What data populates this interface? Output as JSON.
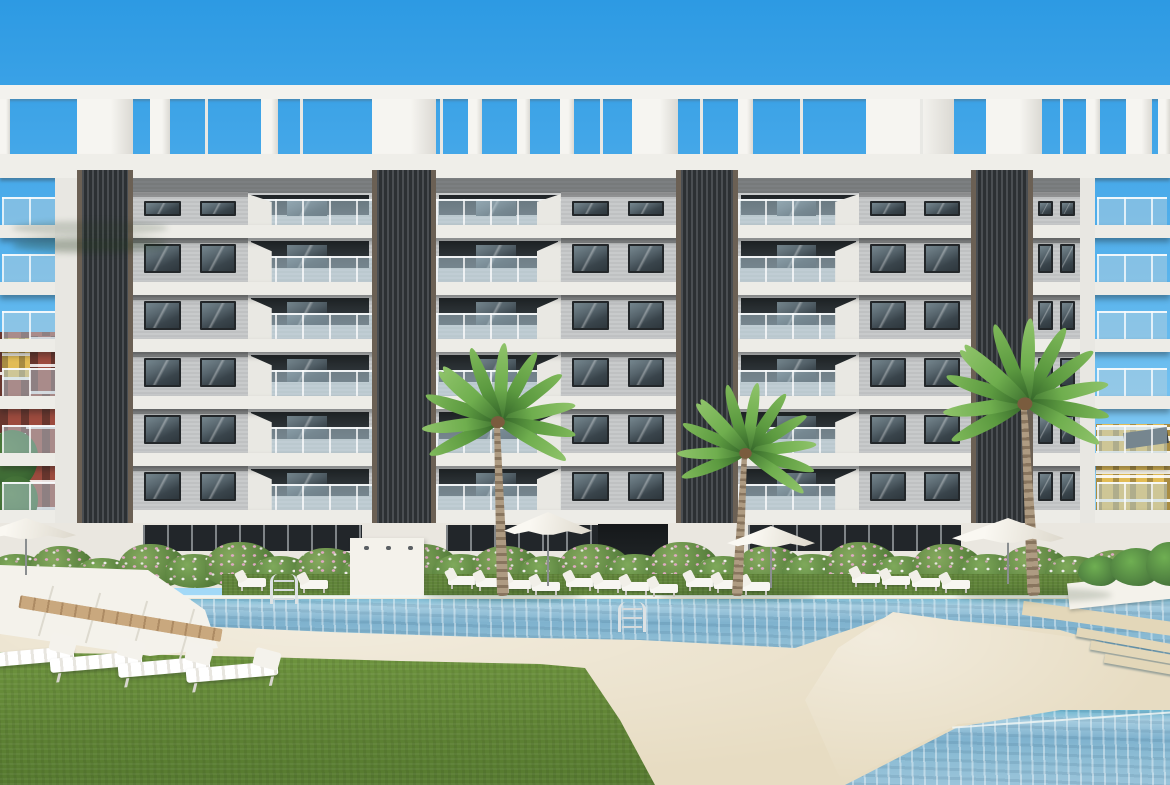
{
  "scene": {
    "description": "3D architectural render of a modern white-and-grey apartment complex with rooftop pergola, balconies, dark louvre columns, flowering hedge, palm trees, parasols, sun loungers, lawns and turquoise swimming pools",
    "colors": {
      "sky_top": "#2d9ae3",
      "sky_horizon": "#cdecfb",
      "facade_wall": "#c5c7c8",
      "slab_white": "#edece7",
      "fascia": "#efeee9",
      "louvre_column": "#303437",
      "column_trim": "#6b6054",
      "window_glass": "#4a575f",
      "balustrade_glass": "#b7d1dd",
      "hedge_green": "#5c8440",
      "flower_pink": "#e2aac8",
      "flower_white": "#f5f0f2",
      "pool_water": "#7fb2ce",
      "deck_sand": "#e7dcc2",
      "grass": "#61853a",
      "wood_deck": "#c9a87e",
      "palm_frond": "#5c9a40",
      "palm_trunk": "#ae9b82",
      "parasol": "#faf8f2",
      "bg_building_red": "#9c4b3e",
      "bg_building_yellow": "#e2bc55"
    },
    "background": {
      "left_blocks": [
        {
          "x": 0,
          "y": 332,
          "w": 62,
          "h": 232,
          "cls": "bgred"
        },
        {
          "x": 2,
          "y": 338,
          "w": 38,
          "h": 42,
          "cls": "bgyellow"
        },
        {
          "x": 0,
          "y": 390,
          "w": 26,
          "h": 46,
          "cls": "bgred"
        },
        {
          "x": 30,
          "y": 336,
          "w": 32,
          "h": 58,
          "cls": "bgred"
        }
      ],
      "left_greens": [
        {
          "x": -14,
          "y": 430,
          "w": 52,
          "h": 58
        },
        {
          "x": -6,
          "y": 476,
          "w": 44,
          "h": 52
        },
        {
          "x": 2,
          "y": 512,
          "w": 40,
          "h": 44
        }
      ],
      "right_block": {
        "x": 1096,
        "y": 424,
        "w": 74,
        "h": 102
      },
      "right_bands": [
        {
          "x": 1096,
          "y": 436,
          "w": 74,
          "h": 5
        },
        {
          "x": 1096,
          "y": 470,
          "w": 74,
          "h": 4
        }
      ],
      "right_solar": {
        "x": 1124,
        "y": 430,
        "w": 44,
        "h": 16
      },
      "right_greens": [
        {
          "x": 1130,
          "y": 518,
          "w": 44,
          "h": 36
        }
      ]
    },
    "pergola": {
      "beam": {
        "y": 85,
        "h": 14
      },
      "piers_y": 99,
      "piers_h": 55,
      "piers": [
        [
          0,
          10
        ],
        [
          77,
          56
        ],
        [
          150,
          20
        ],
        [
          205,
          3
        ],
        [
          261,
          17
        ],
        [
          300,
          3
        ],
        [
          372,
          64
        ],
        [
          440,
          3
        ],
        [
          468,
          14
        ],
        [
          517,
          13
        ],
        [
          560,
          14
        ],
        [
          600,
          3
        ],
        [
          632,
          46
        ],
        [
          700,
          3
        ],
        [
          738,
          15
        ],
        [
          800,
          3
        ],
        [
          866,
          88
        ],
        [
          920,
          3
        ],
        [
          986,
          56
        ],
        [
          1060,
          3
        ],
        [
          1086,
          14
        ],
        [
          1126,
          26
        ],
        [
          1158,
          12
        ]
      ],
      "fascia": {
        "y": 154,
        "h": 24
      }
    },
    "facade": {
      "wall": {
        "x": 66,
        "y": 178,
        "w": 1014,
        "h": 345
      },
      "roof_shadow_h": 15,
      "slab_ys": [
        225,
        282,
        339,
        396,
        453,
        510
      ],
      "slab_h": 13,
      "rows": [
        {
          "y": 192,
          "h": 33,
          "attic": true
        },
        {
          "y": 238,
          "h": 44
        },
        {
          "y": 295,
          "h": 44
        },
        {
          "y": 352,
          "h": 44
        },
        {
          "y": 409,
          "h": 44
        },
        {
          "y": 466,
          "h": 44
        }
      ],
      "bays": [
        {
          "x": 2,
          "w": 54,
          "type": "open"
        },
        {
          "x": 133,
          "w": 239,
          "type": "wb"
        },
        {
          "x": 436,
          "w": 240,
          "type": "bw"
        },
        {
          "x": 738,
          "w": 233,
          "type": "bw"
        },
        {
          "x": 1033,
          "w": 47,
          "type": "sw"
        },
        {
          "x": 1097,
          "w": 70,
          "type": "open"
        }
      ],
      "columns": [
        [
          77,
          56
        ],
        [
          372,
          64
        ],
        [
          676,
          62
        ],
        [
          971,
          62
        ]
      ],
      "column_top": 170,
      "column_bottom": 548,
      "end_walls": [
        [
          55,
          22
        ],
        [
          1080,
          15
        ]
      ]
    },
    "ground": {
      "wall": {
        "y": 523,
        "h": 65
      },
      "entrance": {
        "x": 598,
        "y": 524,
        "w": 70,
        "h": 60
      },
      "shower_wall": {
        "x": 350,
        "y": 538,
        "w": 74,
        "h": 58,
        "dots": 3
      },
      "grass_strip": {
        "x": 222,
        "y": 574,
        "w": 858,
        "h": 26
      },
      "planter": {
        "x": 1068,
        "y": 578,
        "w": 104,
        "h": 26
      },
      "planter_greens": [
        {
          "x": 1078,
          "y": 556,
          "w": 42,
          "h": 30
        },
        {
          "x": 1110,
          "y": 548,
          "w": 52,
          "h": 38
        },
        {
          "x": 1146,
          "y": 542,
          "w": 46,
          "h": 44
        }
      ],
      "deck_plants": [
        {
          "x": 580,
          "y": 700,
          "w": 24,
          "h": 46
        },
        {
          "x": 592,
          "y": 742,
          "w": 20,
          "h": 36
        }
      ]
    },
    "hedge": [
      [
        -12,
        60,
        34,
        1
      ],
      [
        30,
        66,
        42,
        2
      ],
      [
        75,
        58,
        30,
        1
      ],
      [
        118,
        70,
        44,
        2
      ],
      [
        165,
        62,
        34,
        1
      ],
      [
        205,
        74,
        46,
        2
      ],
      [
        252,
        60,
        32,
        1
      ],
      [
        295,
        68,
        40,
        2
      ],
      [
        340,
        58,
        30,
        1
      ],
      [
        388,
        72,
        44,
        2
      ],
      [
        432,
        62,
        34,
        1
      ],
      [
        472,
        70,
        42,
        2
      ],
      [
        518,
        60,
        32,
        1
      ],
      [
        558,
        74,
        44,
        2
      ],
      [
        605,
        64,
        34,
        1
      ],
      [
        648,
        72,
        46,
        2
      ],
      [
        695,
        60,
        32,
        1
      ],
      [
        735,
        70,
        42,
        2
      ],
      [
        782,
        64,
        34,
        1
      ],
      [
        825,
        74,
        46,
        2
      ],
      [
        872,
        62,
        32,
        1
      ],
      [
        912,
        72,
        44,
        2
      ],
      [
        958,
        64,
        34,
        1
      ],
      [
        1000,
        70,
        42,
        2
      ],
      [
        1045,
        60,
        32,
        1
      ],
      [
        1085,
        68,
        38,
        2
      ],
      [
        1125,
        64,
        34,
        1
      ],
      [
        1148,
        60,
        30,
        2
      ]
    ],
    "hedge_bottom": 588,
    "pool": {
      "deck": {
        "y": 596,
        "h": 189
      },
      "main": {
        "x": 35,
        "y": 596,
        "w": 1135,
        "h": 70,
        "points": [
          [
            42,
            599
          ],
          [
            1170,
            599
          ],
          [
            1170,
            662
          ],
          [
            1060,
            630
          ],
          [
            893,
            615
          ],
          [
            795,
            648
          ],
          [
            640,
            640
          ],
          [
            480,
            637
          ],
          [
            330,
            632
          ],
          [
            195,
            626
          ],
          [
            110,
            615
          ],
          [
            42,
            602
          ]
        ]
      },
      "coping": {
        "x": 35,
        "y": 595,
        "w": 1135,
        "h": 3
      },
      "walkway": {
        "x": 760,
        "y": 608,
        "w": 410,
        "h": 178,
        "points": [
          [
            893,
            612
          ],
          [
            1078,
            638
          ],
          [
            1170,
            664
          ],
          [
            1170,
            706
          ],
          [
            958,
            724
          ],
          [
            842,
            783
          ],
          [
            805,
            700
          ],
          [
            838,
            648
          ]
        ]
      },
      "steps": [
        [
          1076,
          636,
          100
        ],
        [
          1090,
          648,
          86
        ],
        [
          1104,
          660,
          72
        ]
      ],
      "kids": {
        "x": 840,
        "y": 710,
        "w": 330,
        "h": 75,
        "points": [
          [
            845,
            785
          ],
          [
            958,
            727
          ],
          [
            1170,
            692
          ],
          [
            1170,
            785
          ]
        ]
      },
      "kids_edge": {
        "x": 952,
        "y": 719,
        "w": 220,
        "h": 2
      },
      "sandband": {
        "x": 1022,
        "y": 612,
        "w": 160,
        "h": 14
      }
    },
    "lawn": {
      "x": 0,
      "y": 648,
      "w": 660,
      "h": 137,
      "points": [
        [
          0,
          785
        ],
        [
          0,
          652
        ],
        [
          120,
          654
        ],
        [
          260,
          657
        ],
        [
          400,
          661
        ],
        [
          540,
          664
        ],
        [
          585,
          668
        ],
        [
          620,
          720
        ],
        [
          655,
          785
        ]
      ]
    },
    "platform": {
      "x": 0,
      "y": 562,
      "w": 225,
      "h": 100,
      "points": [
        [
          0,
          565
        ],
        [
          148,
          570
        ],
        [
          205,
          610
        ],
        [
          218,
          648
        ],
        [
          150,
          656
        ],
        [
          0,
          634
        ]
      ],
      "seams": [
        [
          45,
          585
        ],
        [
          92,
          592
        ],
        [
          139,
          600
        ],
        [
          186,
          608
        ]
      ]
    },
    "wood_strip": {
      "x": 18,
      "y": 612,
      "w": 205,
      "h": 13,
      "rot": 9.5
    },
    "loungers_poolside": [
      [
        238,
        578
      ],
      [
        300,
        580
      ],
      [
        448,
        576
      ],
      [
        476,
        578
      ],
      [
        504,
        580
      ],
      [
        532,
        582
      ],
      [
        566,
        578
      ],
      [
        594,
        580
      ],
      [
        622,
        582
      ],
      [
        650,
        584
      ],
      [
        686,
        578
      ],
      [
        714,
        580
      ],
      [
        742,
        582
      ],
      [
        852,
        574
      ],
      [
        882,
        576
      ],
      [
        912,
        578
      ],
      [
        942,
        580
      ]
    ],
    "loungers_foreground": [
      [
        -18,
        650
      ],
      [
        50,
        655
      ],
      [
        118,
        660
      ],
      [
        186,
        665
      ]
    ],
    "ladders": [
      {
        "x": 270,
        "y": 574,
        "h": 30
      },
      {
        "x": 618,
        "y": 602,
        "h": 30
      }
    ],
    "palms": [
      {
        "x": 503,
        "crown_y": 432,
        "scale": 1.0,
        "lean": -2
      },
      {
        "x": 737,
        "crown_y": 447,
        "scale": 0.9,
        "lean": 3
      },
      {
        "x": 1034,
        "crown_y": 428,
        "scale": 1.08,
        "lean": -3
      }
    ],
    "palm_frond_angles": [
      -35,
      -10,
      12,
      32,
      -60,
      -85,
      -110,
      -135,
      155,
      175,
      200,
      220
    ],
    "umbrellas": [
      {
        "x": -24,
        "y": 518,
        "w": 100,
        "h": 22,
        "pole_to": 575
      },
      {
        "x": 504,
        "y": 512,
        "w": 88,
        "h": 24,
        "pole_to": 586
      },
      {
        "x": 727,
        "y": 526,
        "w": 88,
        "h": 22,
        "pole_to": 588
      },
      {
        "x": 952,
        "y": 518,
        "w": 112,
        "h": 26,
        "pole_to": 584
      }
    ]
  }
}
